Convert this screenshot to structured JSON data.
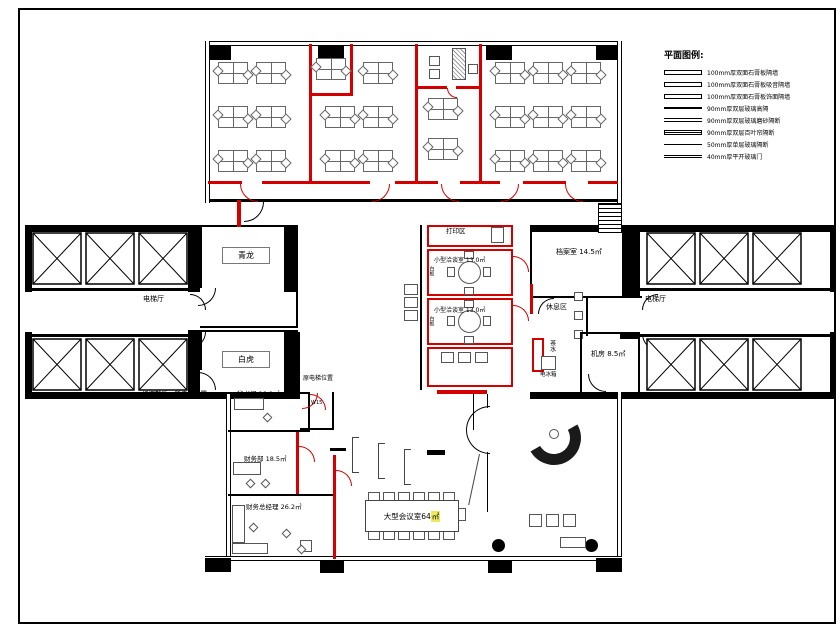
{
  "legend": {
    "title": "平面图例:",
    "items": [
      {
        "label": "100mm厚双面石膏板隔墙"
      },
      {
        "label": "100mm厚双面石膏板吸音隔墙"
      },
      {
        "label": "100mm厚双面石膏板饰面隔墙"
      },
      {
        "label": "90mm厚双层玻璃高隔"
      },
      {
        "label": "90mm厚双层玻璃磨砂隔断"
      },
      {
        "label": "90mm厚双层百叶帘隔断"
      },
      {
        "label": "50mm厚单层玻璃隔断"
      },
      {
        "label": "40mm厚平开玻璃门"
      }
    ]
  },
  "labels": {
    "qinglong": "青龙",
    "baihu": "白虎",
    "elevator_hall_left": "电梯厅",
    "elevator_hall_right": "电梯厅",
    "archive": "档案室 14.5㎡",
    "rest_area": "休息区",
    "tea": "茶水",
    "machine_room": "机房 8.5㎡",
    "fridge": "电冰箱",
    "print_area": "打印区",
    "meeting_small_1": "小型洽谈室 13.0㎡",
    "whiteboard_1": "白板",
    "meeting_small_2": "小型洽谈室 13.0㎡",
    "whiteboard_2": "白板",
    "note_old_elevator": "原电梯位置",
    "note_new_elevator": "经调整后，新电梯位置",
    "door_code": "W15",
    "secretary": "秘书间 10.9㎡",
    "finance": "财务部 18.5㎡",
    "finance_director": "财务总经理 26.2㎡",
    "conference": "大型会议室64",
    "conference_unit": "㎡"
  },
  "colors": {
    "existing_wall": "#000000",
    "new_partition": "#d40000",
    "area_highlight": "#efe85e"
  }
}
